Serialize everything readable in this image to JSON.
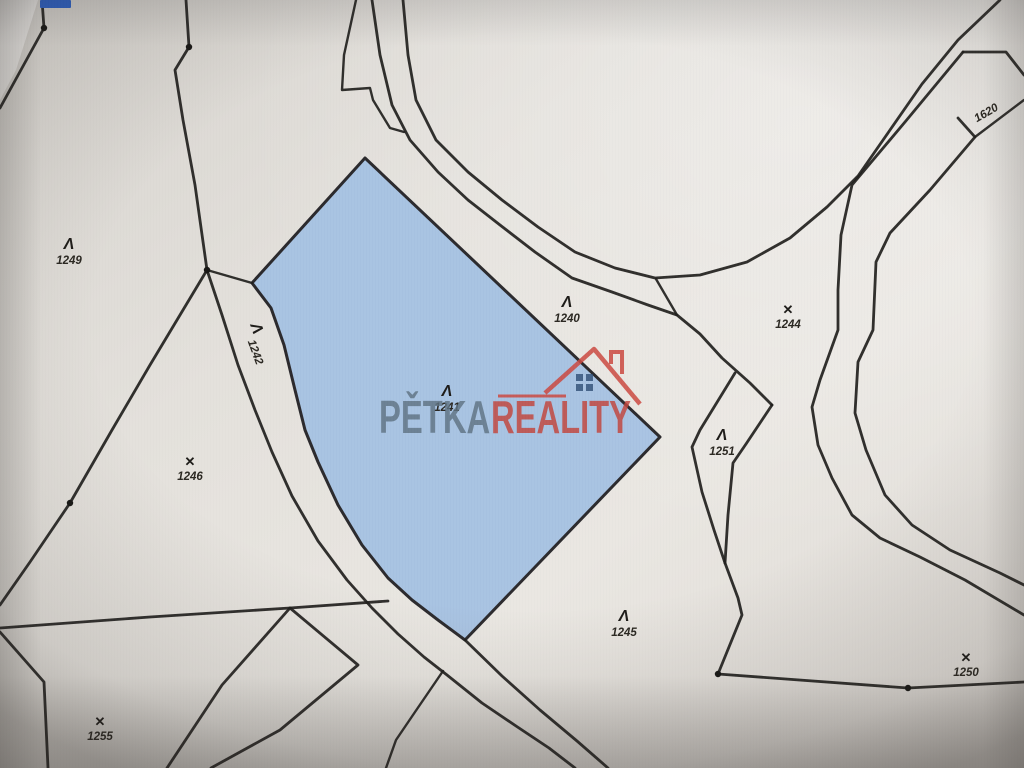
{
  "map": {
    "background_color": "#e3e0da",
    "highlight_color": "#a2c0e3",
    "line_color": "#1f1e1c",
    "chip_color": "#2d62c8",
    "watermark": {
      "part1": "PĚTKA",
      "part2": "REALITY",
      "part1_color": "#5f7383",
      "part2_color": "#c2453c",
      "logo": "house-logo",
      "logo_color": "#cc4a42",
      "window_color": "#2b4a70"
    },
    "parcels": [
      {
        "id": "1249",
        "symbol": "Λ",
        "land_use": "grassland"
      },
      {
        "id": "1242",
        "symbol": "Λ",
        "land_use": "grassland"
      },
      {
        "id": "1240",
        "symbol": "Λ",
        "land_use": "grassland"
      },
      {
        "id": "1244",
        "symbol": "✕",
        "land_use": "orchard"
      },
      {
        "id": "1620",
        "symbol": "",
        "land_use": "none"
      },
      {
        "id": "1241",
        "symbol": "Λ",
        "land_use": "grassland",
        "highlighted": true
      },
      {
        "id": "1251",
        "symbol": "Λ",
        "land_use": "grassland"
      },
      {
        "id": "1246",
        "symbol": "✕",
        "land_use": "orchard"
      },
      {
        "id": "1245",
        "symbol": "Λ",
        "land_use": "grassland"
      },
      {
        "id": "1250",
        "symbol": "✕",
        "land_use": "orchard"
      },
      {
        "id": "1255",
        "symbol": "✕",
        "land_use": "orchard"
      }
    ]
  }
}
